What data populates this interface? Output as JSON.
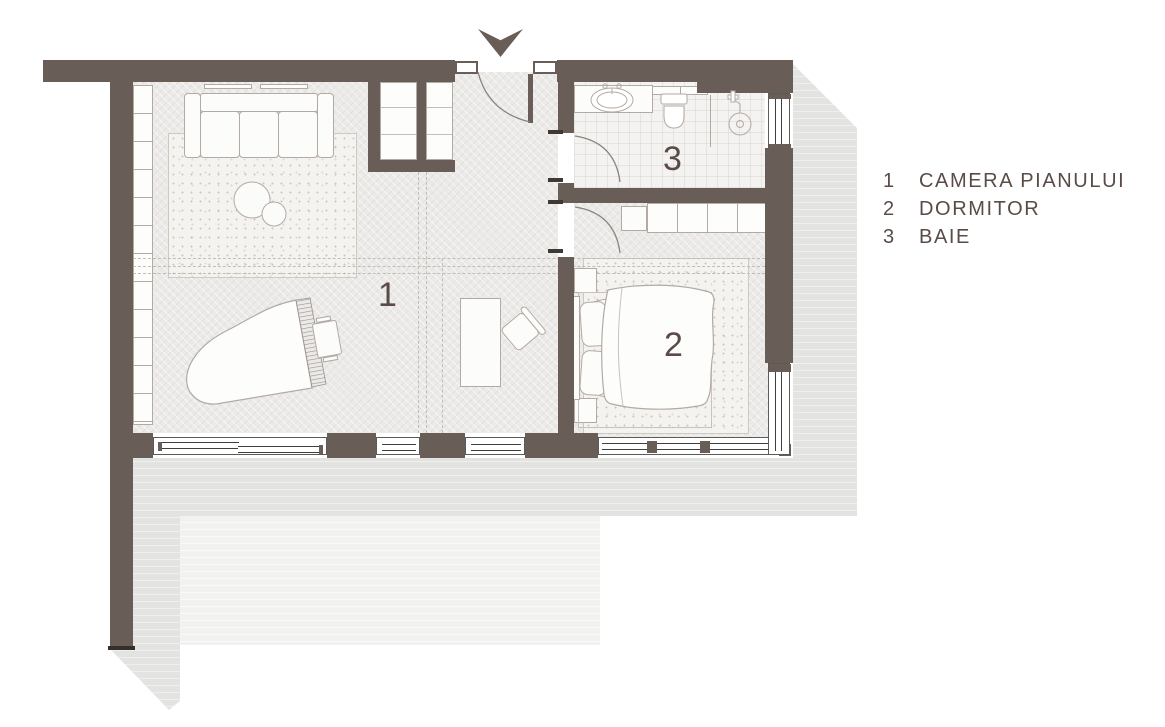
{
  "title": "apartment-floor-plan",
  "rooms": [
    {
      "number": "1",
      "name": "camera-pianului"
    },
    {
      "number": "2",
      "name": "dormitor"
    },
    {
      "number": "3",
      "name": "baie"
    }
  ],
  "legend": {
    "items": [
      {
        "number": "1",
        "label": "CAMERA PIANULUI"
      },
      {
        "number": "2",
        "label": "DORMITOR"
      },
      {
        "number": "3",
        "label": "BAIE"
      }
    ]
  },
  "icons": {
    "entrance_arrow": "entrance-arrow"
  },
  "colors": {
    "wall": "#695d58",
    "text": "#5a4b46",
    "furniture_stroke": "#b3aaa4",
    "shadow": "#e3e3e2",
    "shadow_light": "#f2f2f1",
    "floor": "#ebeae8"
  }
}
